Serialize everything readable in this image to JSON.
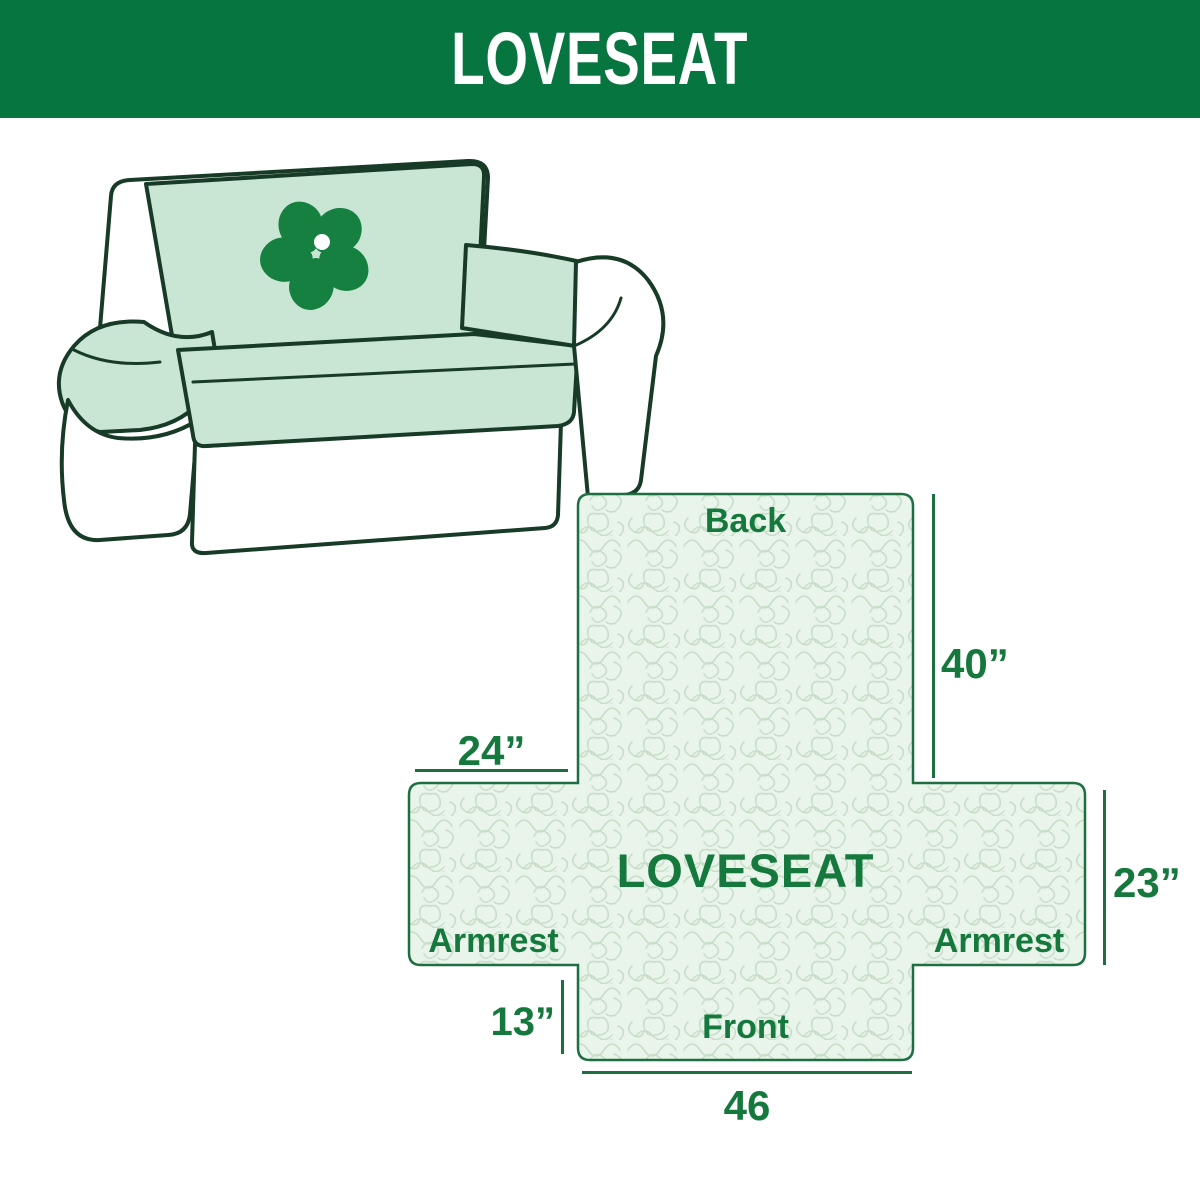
{
  "header": {
    "title": "LOVESEAT",
    "bg_color": "#077540",
    "text_color": "#ffffff"
  },
  "illustration": {
    "subject": "loveseat sofa with quilted slipcover",
    "logo_icon": "pinwheel-icon",
    "cover_color": "#c9e5d4",
    "outline_color": "#173b26",
    "logo_color": "#15803f"
  },
  "diagram": {
    "center_label": "LOVESEAT",
    "sections": {
      "back": "Back",
      "front": "Front",
      "armrest_left": "Armrest",
      "armrest_right": "Armrest"
    },
    "dimensions": {
      "back_height": "40”",
      "armrest_width": "24”",
      "armrest_height": "23”",
      "front_height": "13”",
      "front_width": "46"
    },
    "fill_color": "#e9f5ea",
    "quilt_line_color": "#c8dec9",
    "border_color": "#1d6f42",
    "text_color": "#15793d"
  }
}
